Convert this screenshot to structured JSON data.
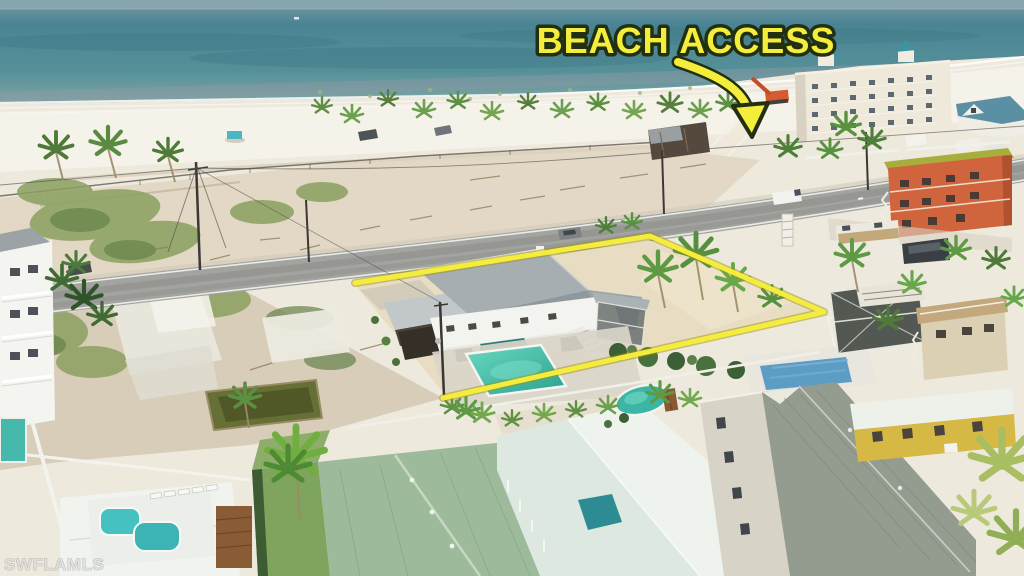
{
  "image": {
    "type": "aerial-drone-photo",
    "description": "Aerial photo of a beachfront home and lot outlined in yellow, with beach access annotation, Gulf beach and neighboring houses",
    "width": 1024,
    "height": 576
  },
  "overlay": {
    "beach_access_label": "BEACH ACCESS",
    "colors": {
      "label_fill": "#f5ed3b",
      "label_outline": "#223011",
      "property_outline": "#f5ed3b"
    },
    "property_outline": {
      "points": "355,283 650,236 824,312 700,340 443,398"
    },
    "arrow": {
      "path": "M678,62 C714,74 744,88 749,114",
      "head_points": "733,106 768,103 752,137"
    }
  },
  "watermark": {
    "text": "SWFLAMLS"
  },
  "scene": {
    "colors": {
      "ocean": "#4e8795",
      "beach_sand": "#f0ece0",
      "lot_sand": "#ddd2bc",
      "road": "#a3a3a0",
      "pool_water": "#3ec4ae",
      "subject_roof": "#a6aeb2",
      "orange_building": "#d0653d",
      "green_roof_house": "#9dbb9b"
    },
    "elements": [
      "gulf-water",
      "shoreline-foam",
      "beach",
      "beach-palms",
      "lifeguard-tent",
      "beach-trucks",
      "condo-building",
      "excavator",
      "beach-access-path",
      "estero-road",
      "utility-poles",
      "orange-three-story-building",
      "rv-camper",
      "subject-property-lot",
      "subject-house",
      "subject-pool",
      "vacant-lots",
      "abandoned-pond",
      "white-three-story-house",
      "neighbor-pools",
      "screened-pool-cage",
      "tan-stilt-house",
      "yellow-cottage",
      "gray-shingle-house",
      "white-roof-motel",
      "green-metal-roof-house",
      "spa-pool",
      "lawn-strip",
      "palm-trees",
      "white-vinyl-fences"
    ]
  }
}
